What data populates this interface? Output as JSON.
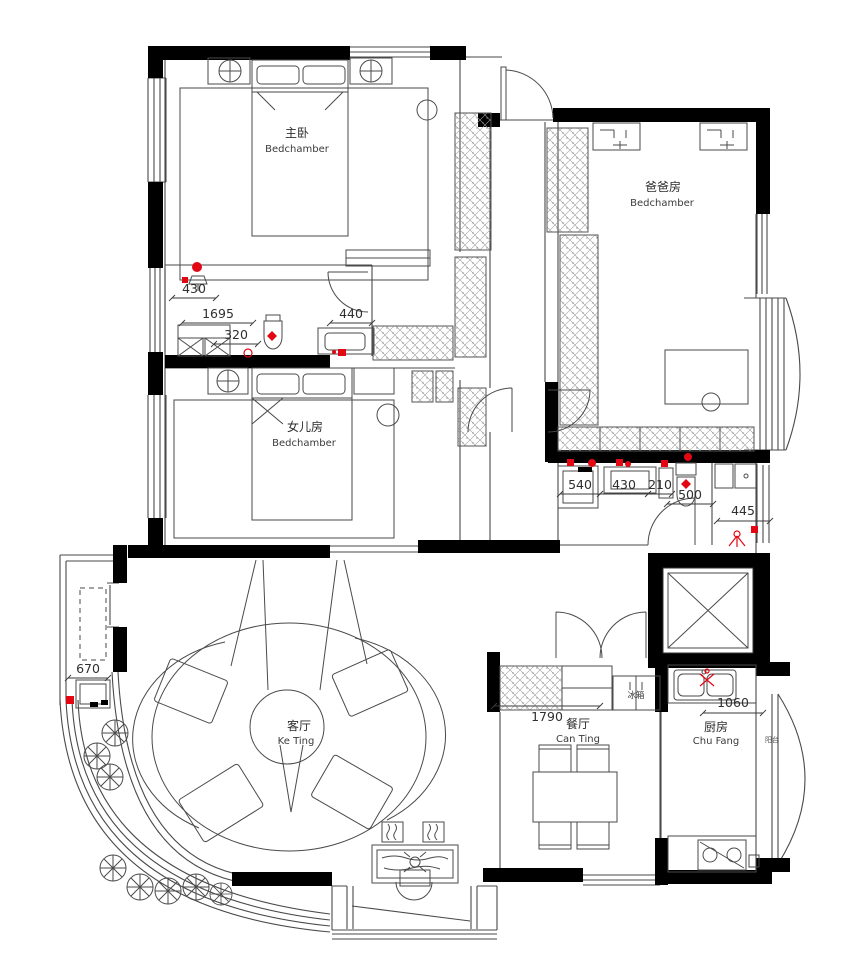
{
  "rooms": {
    "master": {
      "cn": "主卧",
      "en": "Bedchamber"
    },
    "daughter": {
      "cn": "女儿房",
      "en": "Bedchamber"
    },
    "dad": {
      "cn": "爸爸房",
      "en": "Bedchamber"
    },
    "living": {
      "cn": "客厅",
      "en": "Ke Ting"
    },
    "dining": {
      "cn": "餐厅",
      "en": "Can Ting"
    },
    "kitchen": {
      "cn": "厨房",
      "en": "Chu Fang"
    },
    "side_balcony": {
      "cn": "阳台",
      "en": ""
    }
  },
  "appliances": {
    "fridge": "冰箱"
  },
  "dimensions": {
    "bath1_a": "430",
    "bath1_b": "1695",
    "bath1_c": "320",
    "bath1_d": "440",
    "bath2_a": "540",
    "bath2_b": "430",
    "bath2_c": "210",
    "bath2_d": "500",
    "bath2_e": "445",
    "balcony": "670",
    "dining": "1790",
    "kitchen": "1060"
  },
  "colors": {
    "wall": "#000000",
    "line": "#4a4a4a",
    "accent": "#e30613"
  }
}
